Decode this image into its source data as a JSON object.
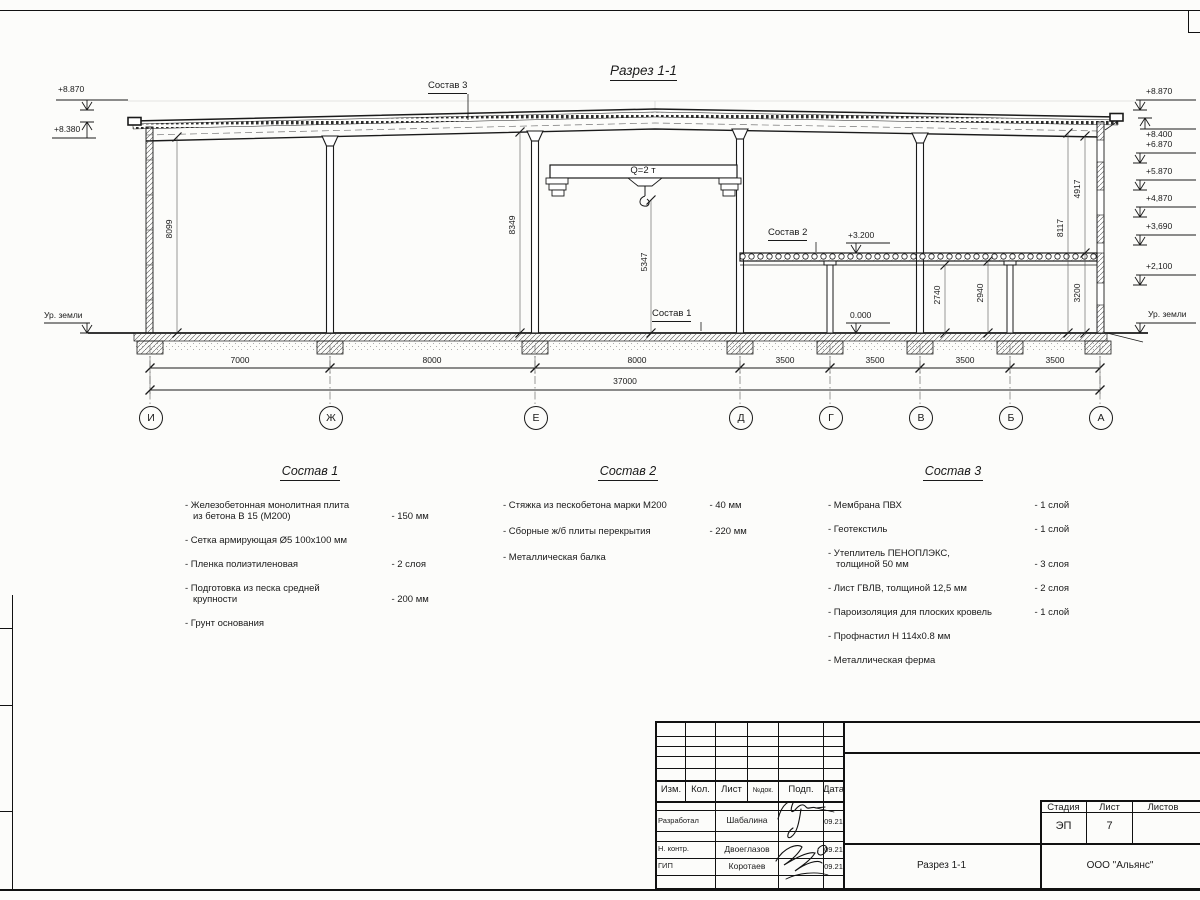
{
  "sheet": {
    "section_title": "Разрез 1-1"
  },
  "drawing": {
    "crane_label": "Q=2 т",
    "callout_roof": "Состав 3",
    "callout_slab": "Состав 2",
    "callout_floor": "Состав 1",
    "level_slab": "+3.200",
    "level_zero": "0.000",
    "ground_left": "Ур. земли",
    "ground_right": "Ур. земли"
  },
  "elevations_left": [
    "+8.870",
    "+8.380"
  ],
  "elevations_right": [
    "+8.870",
    "+8.400",
    "+6.870",
    "+5.870",
    "+4,870",
    "+3,690",
    "+2,100"
  ],
  "axes": [
    "И",
    "Ж",
    "Е",
    "Д",
    "Г",
    "В",
    "Б",
    "А"
  ],
  "span_dims": [
    "7000",
    "8000",
    "8000",
    "3500",
    "3500",
    "3500",
    "3500"
  ],
  "total_dim": "37000",
  "vertical_dims": [
    "8099",
    "8349",
    "5347",
    "2740",
    "2940",
    "3200",
    "8117",
    "4917"
  ],
  "specs": [
    {
      "title": "Состав 1",
      "items": [
        {
          "name": "- Железобетонная  монолитная плита\nиз бетона В 15 (М200)",
          "value": "- 150 мм"
        },
        {
          "name": "- Сетка армирующая Ø5 100х100 мм",
          "value": ""
        },
        {
          "name": "- Пленка полиэтиленовая",
          "value": "-  2 слоя"
        },
        {
          "name": "- Подготовка из песка средней\nкрупности",
          "value": "- 200 мм"
        },
        {
          "name": "- Грунт основания",
          "value": ""
        }
      ]
    },
    {
      "title": "Состав 2",
      "items": [
        {
          "name": "- Стяжка из пескобетона марки М200",
          "value": "- 40 мм"
        },
        {
          "name": "- Сборные ж/б плиты перекрытия",
          "value": "- 220 мм"
        },
        {
          "name": "- Металлическая балка",
          "value": ""
        }
      ]
    },
    {
      "title": "Состав 3",
      "items": [
        {
          "name": "- Мембрана ПВХ",
          "value": "- 1 слой"
        },
        {
          "name": "- Геотекстиль",
          "value": "- 1 слой"
        },
        {
          "name": "- Утеплитель ПЕНОПЛЭКС,\nтолщиной 50 мм",
          "value": "- 3 слоя"
        },
        {
          "name": "- Лист ГВЛВ, толщиной 12,5 мм",
          "value": "- 2 слоя"
        },
        {
          "name": "- Пароизоляция для плоских кровель",
          "value": "- 1 слой"
        },
        {
          "name": "- Профнастил Н 114х0.8 мм",
          "value": ""
        },
        {
          "name": "- Металлическая ферма",
          "value": ""
        }
      ]
    }
  ],
  "title_block": {
    "header": [
      "Изм.",
      "Кол.",
      "Лист",
      "№док.",
      "Подп.",
      "Дата"
    ],
    "rows": [
      {
        "role": "Разработал",
        "name": "Шабалина",
        "date": "09.21"
      },
      {
        "role": "Н. контр.",
        "name": "Двоеглазов",
        "date": "09.21"
      },
      {
        "role": "ГИП",
        "name": "Коротаев",
        "date": "09.21"
      }
    ],
    "stage_header": [
      "Стадия",
      "Лист",
      "Листов"
    ],
    "stage": "ЭП",
    "sheet_no": "7",
    "doc_name": "Разрез 1-1",
    "company": "ООО \"Альянс\""
  }
}
